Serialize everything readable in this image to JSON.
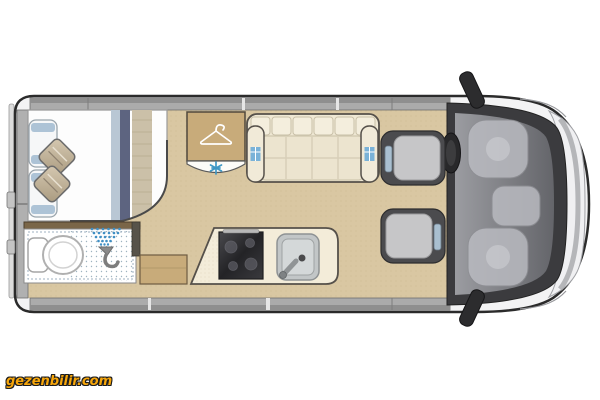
{
  "watermark": {
    "text": "gezenbilir.com",
    "color": "#F7A60A",
    "outline": "#1D1D1D"
  },
  "floorplan": {
    "type": "campervan-floorplan-top-view",
    "colors": {
      "floor": "#D9C7A2",
      "counter_cream": "#F3ECD9",
      "wood": "#C8AB7A",
      "wood_dark": "#7A6648",
      "sofa_cream": "#EFE8D4",
      "accent_blue": "#4A97C6",
      "navy_stripe": "#5D6480",
      "light_blue_stripe": "#B9C7D4",
      "pillow_blue": "#ADC3D6",
      "wall_gray": "#ABABAB",
      "cab_dark": "#3B3B3E",
      "seat_gray": "#C6C6C8",
      "hob_dark": "#2B2B2E",
      "sink_steel": "#C2C6C7",
      "bed_white": "#FDFDFD"
    },
    "rear_bed": {
      "pillow_count": 2,
      "cushion_count": 2
    },
    "bathroom": {
      "fixtures": [
        "toilet",
        "shower-head",
        "spray-dots"
      ]
    },
    "wardrobe": {
      "icon": "hanger-icon"
    },
    "heater": {
      "icon": "snowflake-icon"
    },
    "lounge": {
      "sofa_backrest_sections": 6,
      "sofa_seat_columns": 4
    },
    "kitchen": {
      "fixtures": [
        "hob",
        "sink",
        "faucet"
      ]
    },
    "cab": {
      "seats": [
        "driver-seat",
        "passenger-seat"
      ],
      "fixtures": [
        "steering-wheel",
        "dashboard",
        "windscreen",
        "door-mirror-top",
        "door-mirror-bottom"
      ]
    }
  }
}
